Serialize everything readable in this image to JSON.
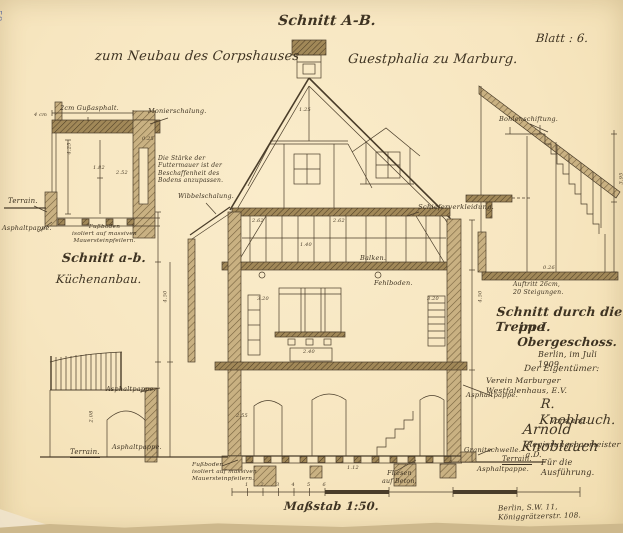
{
  "stamp": "58",
  "titles": {
    "section": "Schnitt A-B.",
    "project_left": "zum Neubau des Corpshauses",
    "project_right": "Guestphalia zu Marburg.",
    "sheet": "Blatt : 6."
  },
  "kitchen_section": {
    "gussasphalt": "2cm Gußasphalt.",
    "schalung": "Monierschalung.",
    "note": "Die Stärke der\nFuttermauer ist der\nBeschaffenheit des\nBodens anzupassen.",
    "terrain": "Terrain.",
    "asphaltpappe": "Asphaltpappe.",
    "fussboden": "Fußboden\nisoliert auf massiven\nMauersteinpfeilern.",
    "caption1": "Schnitt a-b.",
    "caption2": "Küchenanbau."
  },
  "main_section": {
    "wibbelschalung": "Wibbelschalung.",
    "schiefer": "Schieferverkleidung.",
    "balken": "Balken.",
    "fehlboden": "Fehlboden.",
    "terrain": "Terrain.",
    "asphaltpappe_upper": "Asphaltpappe.",
    "asphaltpappe_lower": "Asphaltpappe.",
    "fussboden": "Fußboden\nisoliert auf massiven\nMauersteinpfeilern.",
    "fliesen": "Fliesen\nauf Beton."
  },
  "stair_section": {
    "bohlenschiftung": "Bohlenschiftung.",
    "auftritt": "Auftritt 26cm,\n20 Steigungen.",
    "caption1": "Schnitt durch die Treppe",
    "caption2": "im I. Obergeschoss."
  },
  "right_block": {
    "date": "Berlin, im Juli 1909.",
    "owner_heading": "Der Eigentümer:",
    "owner_name": "Verein Marburger Westfalenhaus, E.V.",
    "asphaltpappe_upper": "Asphaltpappe.",
    "signature1": "R. Knoblauch.",
    "signature1_role": "Vorstand.",
    "signature2": "Arnold Knoblauch",
    "signature2_role": "Regierungsbaumeister a.D.",
    "granitschwelle": "Granitschwelle.",
    "terrain": "Terrain.",
    "execution": "Für die Ausführung.",
    "asphaltpappe_lower": "Asphaltpappe.",
    "address": "Berlin, S.W. 11, Königgrätzerstr. 108."
  },
  "scale": {
    "caption": "Maßstab 1:50.",
    "ticks": [
      "1",
      "2",
      "3",
      "4",
      "5",
      "6"
    ]
  },
  "dims": [
    {
      "x": 64,
      "y": 146,
      "t": "4.25",
      "r": -90
    },
    {
      "x": 34,
      "y": 113,
      "t": "4 cm"
    },
    {
      "x": 93,
      "y": 166,
      "t": "1.82"
    },
    {
      "x": 116,
      "y": 171,
      "t": "2.52"
    },
    {
      "x": 142,
      "y": 137,
      "t": "0.25"
    },
    {
      "x": 252,
      "y": 219,
      "t": "2.62"
    },
    {
      "x": 333,
      "y": 219,
      "t": "2.62"
    },
    {
      "x": 299,
      "y": 108,
      "t": "1.25"
    },
    {
      "x": 300,
      "y": 243,
      "t": "1.40"
    },
    {
      "x": 257,
      "y": 297,
      "t": "3.20"
    },
    {
      "x": 427,
      "y": 297,
      "t": "3.20"
    },
    {
      "x": 303,
      "y": 350,
      "t": "2.40"
    },
    {
      "x": 160,
      "y": 294,
      "t": "4.50",
      "r": -90
    },
    {
      "x": 475,
      "y": 294,
      "t": "4.50",
      "r": -90
    },
    {
      "x": 236,
      "y": 414,
      "t": "2.55"
    },
    {
      "x": 347,
      "y": 466,
      "t": "1.12"
    },
    {
      "x": 86,
      "y": 414,
      "t": "2.08",
      "r": -90
    },
    {
      "x": 616,
      "y": 176,
      "t": "3.95",
      "r": -90
    },
    {
      "x": 543,
      "y": 266,
      "t": "0.26"
    }
  ]
}
